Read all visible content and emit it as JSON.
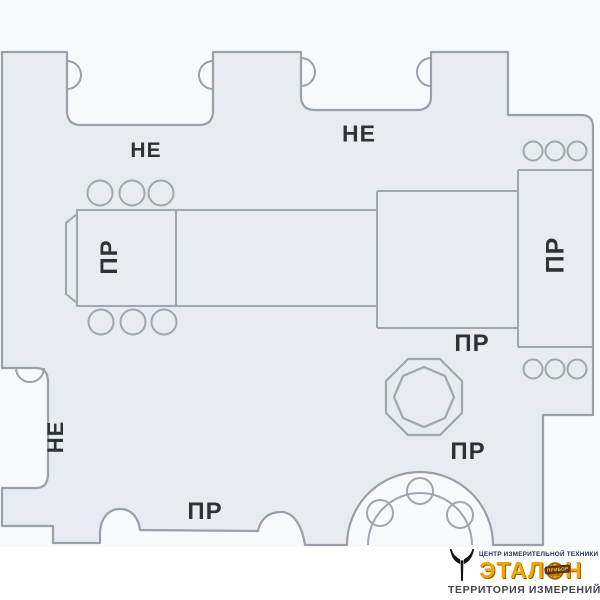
{
  "drawing": {
    "description": "Technical outline drawing of a complex limit gauge (template) with GO / NO-GO zones",
    "labels": {
      "ne_top_left": "НЕ",
      "ne_top_right": "НЕ",
      "ne_left_side": "НЕ",
      "pr_left_block": "ПР",
      "pr_right_column": "ПР",
      "pr_middle": "ПР",
      "pr_octagon": "ПР",
      "pr_bottom": "ПР"
    },
    "colors": {
      "background": "#f8f9fb",
      "part_fill": "#e9ebf2",
      "outline": "#9aa0aa",
      "label_text": "#2e3136"
    }
  },
  "logo": {
    "tagline_top": "ЦЕНТР ИЗМЕРИТЕЛЬНОЙ ТЕХНИКИ",
    "brand": "ЭТАЛОН",
    "brand_part1": "ЭТАЛ",
    "brand_part2": "Н",
    "badge": "ПРИБОР",
    "tagline_bottom": "ТЕРРИТОРИЯ ИЗМЕРЕНИЙ",
    "colors": {
      "brand_yellow": "#f2a400",
      "tagline_top_navy": "#1d2a52",
      "tagline_bottom_gray": "#41454d",
      "icon_black": "#141414",
      "badge_brown": "#6b3410"
    }
  }
}
